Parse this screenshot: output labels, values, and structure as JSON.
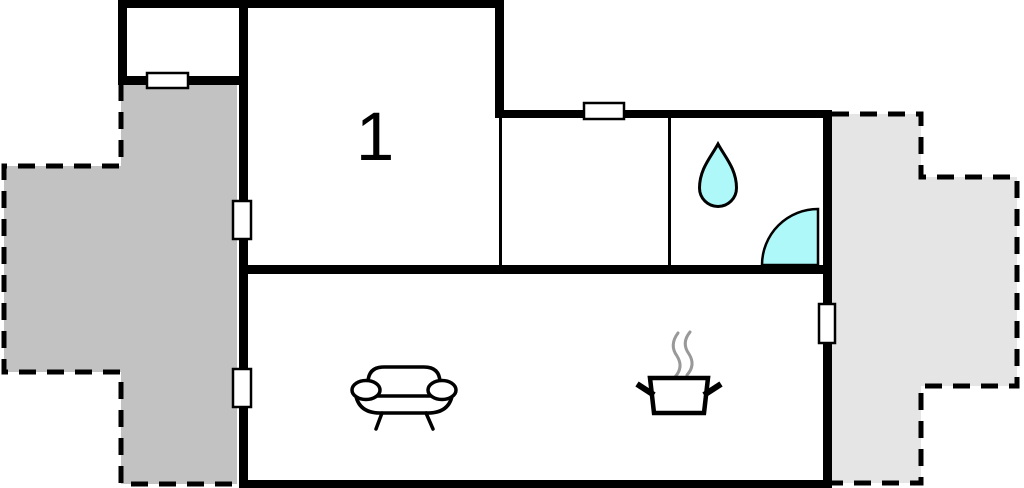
{
  "floorplan": {
    "room_labels": {
      "bedroom1": "1"
    },
    "colors": {
      "walls": "#000000",
      "interior": "#ffffff",
      "terrace_left": "#c2c2c2",
      "terrace_right": "#e5e5e5",
      "fixture_fill": "#aff8fa",
      "steam": "#999999"
    },
    "icons": {
      "bathroom": [
        "water-drop-icon",
        "door-swing-icon"
      ],
      "living_area": [
        "sofa-icon"
      ],
      "kitchen": [
        "cooking-pot-icon",
        "steam-icon"
      ]
    }
  }
}
